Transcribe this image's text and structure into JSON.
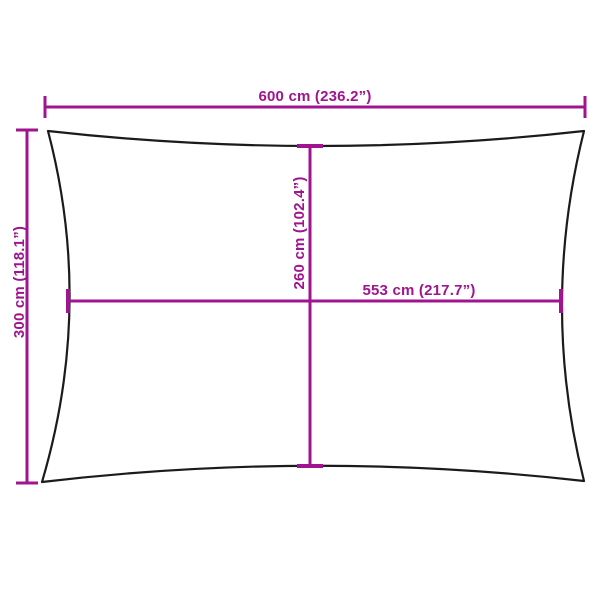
{
  "colors": {
    "dimension": "#A0148F",
    "outline": "#1B1B1B",
    "background": "#FFFFFF"
  },
  "diagram": {
    "dimensions": {
      "width": {
        "cm": "600",
        "inches": "236.2",
        "label": "600 cm (236.2”)"
      },
      "height": {
        "cm": "300",
        "inches": "118.1",
        "label": "300 cm (118.1”)"
      },
      "center_height": {
        "cm": "260",
        "inches": "102.4",
        "label": "260 cm (102.4”)"
      },
      "center_width": {
        "cm": "553",
        "inches": "217.7",
        "label": "553 cm (217.7”)"
      }
    }
  }
}
